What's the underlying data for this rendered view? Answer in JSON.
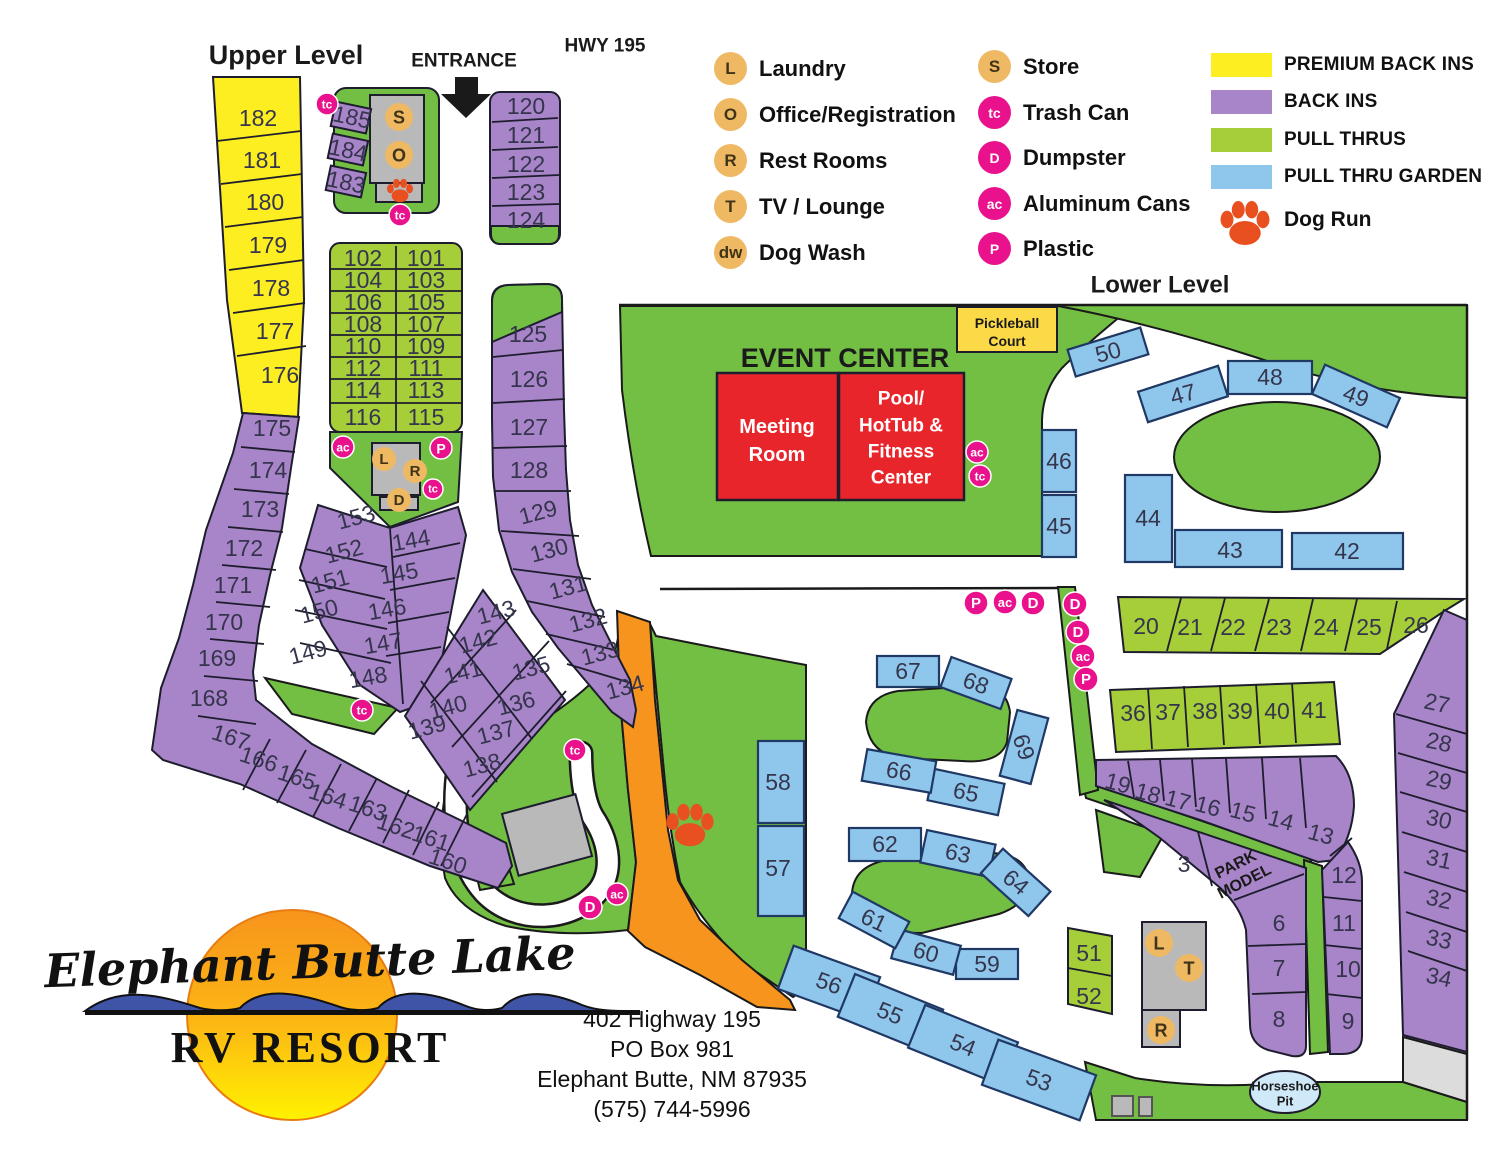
{
  "titles": {
    "upper_level": "Upper Level",
    "entrance": "ENTRANCE",
    "hwy": "HWY 195",
    "lower_level": "Lower Level",
    "event_center": "EVENT CENTER",
    "park_model": [
      "PARK",
      "MODEL"
    ],
    "horseshoe": [
      "Horseshoe",
      "Pit"
    ],
    "pickleball": [
      "Pickleball",
      "Court"
    ],
    "meeting_room": [
      "Meeting",
      "Room"
    ],
    "pool": [
      "Pool/",
      "HotTub &",
      "Fitness",
      "Center"
    ]
  },
  "legend": {
    "facilities": [
      {
        "abbr": "L",
        "label": "Laundry",
        "style": "tan"
      },
      {
        "abbr": "O",
        "label": "Office/Registration",
        "style": "tan"
      },
      {
        "abbr": "R",
        "label": "Rest Rooms",
        "style": "tan"
      },
      {
        "abbr": "T",
        "label": "TV / Lounge",
        "style": "tan"
      },
      {
        "abbr": "dw",
        "label": "Dog Wash",
        "style": "tan"
      },
      {
        "abbr": "S",
        "label": "Store",
        "style": "tan"
      },
      {
        "abbr": "tc",
        "label": "Trash Can",
        "style": "pink"
      },
      {
        "abbr": "D",
        "label": "Dumpster",
        "style": "pink"
      },
      {
        "abbr": "ac",
        "label": "Aluminum Cans",
        "style": "pink"
      },
      {
        "abbr": "P",
        "label": "Plastic",
        "style": "pink"
      }
    ],
    "site_types": [
      {
        "label": "PREMIUM BACK INS",
        "color": "#fcee21"
      },
      {
        "label": "BACK INS",
        "color": "#a884c8"
      },
      {
        "label": "PULL THRUS",
        "color": "#a6ce39"
      },
      {
        "label": "PULL THRU GARDEN",
        "color": "#8fc7ec"
      }
    ],
    "dog_run": "Dog Run"
  },
  "logo": {
    "script_line": "Elephant Butte Lake",
    "rv_line": "RV RESORT"
  },
  "address": {
    "lines": [
      "402 Highway 195",
      "PO Box 981",
      "Elephant Butte, NM 87935",
      "(575) 744-5996"
    ]
  },
  "colors": {
    "area_green": "#72bf44",
    "site_green": "#a6ce39",
    "back_in_purple": "#a884c8",
    "premium_yellow": "#fcee21",
    "garden_blue": "#8fc7ec",
    "road_orange": "#f7941d",
    "building_red": "#e8252a",
    "building_gray": "#b9b9b9",
    "marker_pink": "#e9118c",
    "marker_tan": "#efb964",
    "paw_orange": "#e8511f",
    "horseshoe_blue": "#cfe9f8"
  },
  "map": {
    "sites": [
      {
        "n": "182",
        "x": 258,
        "y": 118
      },
      {
        "n": "181",
        "x": 262,
        "y": 160
      },
      {
        "n": "180",
        "x": 265,
        "y": 202
      },
      {
        "n": "179",
        "x": 268,
        "y": 245
      },
      {
        "n": "178",
        "x": 271,
        "y": 288
      },
      {
        "n": "177",
        "x": 275,
        "y": 331
      },
      {
        "n": "176",
        "x": 280,
        "y": 375
      },
      {
        "n": "175",
        "x": 272,
        "y": 428
      },
      {
        "n": "174",
        "x": 268,
        "y": 470
      },
      {
        "n": "173",
        "x": 260,
        "y": 509
      },
      {
        "n": "172",
        "x": 244,
        "y": 548
      },
      {
        "n": "171",
        "x": 233,
        "y": 585
      },
      {
        "n": "170",
        "x": 224,
        "y": 622
      },
      {
        "n": "169",
        "x": 217,
        "y": 658
      },
      {
        "n": "168",
        "x": 209,
        "y": 698
      },
      {
        "n": "167",
        "x": 231,
        "y": 737,
        "r": 18
      },
      {
        "n": "166",
        "x": 259,
        "y": 759,
        "r": 18
      },
      {
        "n": "165",
        "x": 297,
        "y": 777,
        "r": 18
      },
      {
        "n": "164",
        "x": 328,
        "y": 796,
        "r": 18
      },
      {
        "n": "163",
        "x": 368,
        "y": 808,
        "r": 18
      },
      {
        "n": "162",
        "x": 396,
        "y": 826,
        "r": 18
      },
      {
        "n": "161",
        "x": 431,
        "y": 838,
        "r": 18
      },
      {
        "n": "160",
        "x": 448,
        "y": 861,
        "r": 18
      },
      {
        "n": "185",
        "x": 352,
        "y": 117,
        "fs": 20,
        "r": 12
      },
      {
        "n": "184",
        "x": 348,
        "y": 150,
        "fs": 20,
        "r": 12
      },
      {
        "n": "183",
        "x": 346,
        "y": 182,
        "fs": 20,
        "r": 12
      },
      {
        "n": "120",
        "x": 526,
        "y": 106,
        "fs": 22
      },
      {
        "n": "121",
        "x": 526,
        "y": 135,
        "fs": 22
      },
      {
        "n": "122",
        "x": 526,
        "y": 164,
        "fs": 22
      },
      {
        "n": "123",
        "x": 526,
        "y": 192,
        "fs": 22
      },
      {
        "n": "124",
        "x": 526,
        "y": 220,
        "fs": 22
      },
      {
        "n": "102",
        "x": 363,
        "y": 258,
        "fs": 22
      },
      {
        "n": "101",
        "x": 426,
        "y": 258,
        "fs": 22
      },
      {
        "n": "104",
        "x": 363,
        "y": 280,
        "fs": 22
      },
      {
        "n": "103",
        "x": 426,
        "y": 280,
        "fs": 22
      },
      {
        "n": "106",
        "x": 363,
        "y": 302,
        "fs": 22
      },
      {
        "n": "105",
        "x": 426,
        "y": 302,
        "fs": 22
      },
      {
        "n": "108",
        "x": 363,
        "y": 324,
        "fs": 22
      },
      {
        "n": "107",
        "x": 426,
        "y": 324,
        "fs": 22
      },
      {
        "n": "110",
        "x": 363,
        "y": 346,
        "fs": 22
      },
      {
        "n": "109",
        "x": 426,
        "y": 346,
        "fs": 22
      },
      {
        "n": "112",
        "x": 363,
        "y": 368,
        "fs": 22
      },
      {
        "n": "111",
        "x": 426,
        "y": 368,
        "fs": 22
      },
      {
        "n": "114",
        "x": 363,
        "y": 390,
        "fs": 22
      },
      {
        "n": "113",
        "x": 426,
        "y": 390,
        "fs": 22
      },
      {
        "n": "116",
        "x": 363,
        "y": 417,
        "fs": 22
      },
      {
        "n": "115",
        "x": 426,
        "y": 417,
        "fs": 22
      },
      {
        "n": "153",
        "x": 356,
        "y": 517,
        "r": -15
      },
      {
        "n": "152",
        "x": 344,
        "y": 551,
        "r": -15
      },
      {
        "n": "151",
        "x": 330,
        "y": 581,
        "r": -15
      },
      {
        "n": "150",
        "x": 319,
        "y": 611,
        "r": -15
      },
      {
        "n": "149",
        "x": 308,
        "y": 652,
        "r": -15
      },
      {
        "n": "144",
        "x": 411,
        "y": 540,
        "r": -10
      },
      {
        "n": "145",
        "x": 399,
        "y": 573,
        "r": -10
      },
      {
        "n": "146",
        "x": 387,
        "y": 609,
        "r": -10
      },
      {
        "n": "147",
        "x": 383,
        "y": 643,
        "r": -10
      },
      {
        "n": "148",
        "x": 368,
        "y": 677,
        "r": -10
      },
      {
        "n": "143",
        "x": 496,
        "y": 612,
        "r": -15
      },
      {
        "n": "142",
        "x": 478,
        "y": 641,
        "r": -15
      },
      {
        "n": "141",
        "x": 463,
        "y": 672,
        "r": -15
      },
      {
        "n": "140",
        "x": 448,
        "y": 707,
        "r": -15
      },
      {
        "n": "139",
        "x": 427,
        "y": 727,
        "r": -15
      },
      {
        "n": "135",
        "x": 531,
        "y": 668,
        "r": -15
      },
      {
        "n": "136",
        "x": 516,
        "y": 703,
        "r": -15
      },
      {
        "n": "137",
        "x": 496,
        "y": 732,
        "r": -15
      },
      {
        "n": "138",
        "x": 482,
        "y": 765,
        "r": -15
      },
      {
        "n": "125",
        "x": 528,
        "y": 334
      },
      {
        "n": "126",
        "x": 529,
        "y": 379
      },
      {
        "n": "127",
        "x": 529,
        "y": 427
      },
      {
        "n": "128",
        "x": 529,
        "y": 470
      },
      {
        "n": "129",
        "x": 538,
        "y": 512,
        "r": -15
      },
      {
        "n": "130",
        "x": 549,
        "y": 550,
        "r": -15
      },
      {
        "n": "131",
        "x": 568,
        "y": 587,
        "r": -15
      },
      {
        "n": "132",
        "x": 588,
        "y": 620,
        "r": -15
      },
      {
        "n": "133",
        "x": 600,
        "y": 653,
        "r": -15
      },
      {
        "n": "134",
        "x": 625,
        "y": 687,
        "r": -15
      },
      {
        "n": "58",
        "x": 778,
        "y": 782
      },
      {
        "n": "57",
        "x": 778,
        "y": 868
      },
      {
        "n": "56",
        "x": 829,
        "y": 983,
        "r": 20
      },
      {
        "n": "55",
        "x": 890,
        "y": 1013,
        "r": 22
      },
      {
        "n": "54",
        "x": 963,
        "y": 1045,
        "r": 22
      },
      {
        "n": "53",
        "x": 1039,
        "y": 1080,
        "r": 20
      },
      {
        "n": "59",
        "x": 987,
        "y": 964
      },
      {
        "n": "60",
        "x": 926,
        "y": 952,
        "r": 15
      },
      {
        "n": "61",
        "x": 874,
        "y": 920,
        "r": 25
      },
      {
        "n": "62",
        "x": 885,
        "y": 844
      },
      {
        "n": "63",
        "x": 958,
        "y": 853,
        "r": 12
      },
      {
        "n": "64",
        "x": 1016,
        "y": 882,
        "r": 40
      },
      {
        "n": "65",
        "x": 966,
        "y": 792,
        "r": 12
      },
      {
        "n": "66",
        "x": 899,
        "y": 771,
        "r": 10
      },
      {
        "n": "67",
        "x": 908,
        "y": 671
      },
      {
        "n": "68",
        "x": 976,
        "y": 683,
        "r": 20
      },
      {
        "n": "69",
        "x": 1024,
        "y": 747,
        "r": 72
      },
      {
        "n": "50",
        "x": 1108,
        "y": 352,
        "r": -15
      },
      {
        "n": "47",
        "x": 1183,
        "y": 394,
        "r": -15
      },
      {
        "n": "48",
        "x": 1270,
        "y": 377
      },
      {
        "n": "49",
        "x": 1356,
        "y": 396,
        "r": 20
      },
      {
        "n": "46",
        "x": 1059,
        "y": 461
      },
      {
        "n": "45",
        "x": 1059,
        "y": 526
      },
      {
        "n": "44",
        "x": 1148,
        "y": 518
      },
      {
        "n": "43",
        "x": 1230,
        "y": 550
      },
      {
        "n": "42",
        "x": 1347,
        "y": 551
      },
      {
        "n": "51",
        "x": 1089,
        "y": 953
      },
      {
        "n": "52",
        "x": 1089,
        "y": 996
      },
      {
        "n": "20",
        "x": 1146,
        "y": 626
      },
      {
        "n": "21",
        "x": 1190,
        "y": 627
      },
      {
        "n": "22",
        "x": 1233,
        "y": 627
      },
      {
        "n": "23",
        "x": 1279,
        "y": 627
      },
      {
        "n": "24",
        "x": 1326,
        "y": 627
      },
      {
        "n": "25",
        "x": 1369,
        "y": 627
      },
      {
        "n": "26",
        "x": 1416,
        "y": 625
      },
      {
        "n": "36",
        "x": 1133,
        "y": 713
      },
      {
        "n": "37",
        "x": 1168,
        "y": 712
      },
      {
        "n": "38",
        "x": 1205,
        "y": 711
      },
      {
        "n": "39",
        "x": 1240,
        "y": 711
      },
      {
        "n": "40",
        "x": 1277,
        "y": 711
      },
      {
        "n": "41",
        "x": 1314,
        "y": 710
      },
      {
        "n": "19",
        "x": 1118,
        "y": 783,
        "r": 15
      },
      {
        "n": "18",
        "x": 1148,
        "y": 793,
        "r": 15
      },
      {
        "n": "17",
        "x": 1178,
        "y": 800,
        "r": 15
      },
      {
        "n": "16",
        "x": 1208,
        "y": 806,
        "r": 15
      },
      {
        "n": "15",
        "x": 1243,
        "y": 812,
        "r": 15
      },
      {
        "n": "14",
        "x": 1281,
        "y": 820,
        "r": 15
      },
      {
        "n": "13",
        "x": 1321,
        "y": 834,
        "r": 15
      },
      {
        "n": "3",
        "x": 1184,
        "y": 864
      },
      {
        "n": "12",
        "x": 1344,
        "y": 875
      },
      {
        "n": "11",
        "x": 1344,
        "y": 923
      },
      {
        "n": "6",
        "x": 1279,
        "y": 923
      },
      {
        "n": "7",
        "x": 1279,
        "y": 968
      },
      {
        "n": "10",
        "x": 1348,
        "y": 969
      },
      {
        "n": "8",
        "x": 1279,
        "y": 1019
      },
      {
        "n": "9",
        "x": 1348,
        "y": 1021
      },
      {
        "n": "27",
        "x": 1437,
        "y": 703,
        "r": 12
      },
      {
        "n": "28",
        "x": 1439,
        "y": 742,
        "r": 12
      },
      {
        "n": "29",
        "x": 1439,
        "y": 780,
        "r": 12
      },
      {
        "n": "30",
        "x": 1439,
        "y": 819,
        "r": 12
      },
      {
        "n": "31",
        "x": 1439,
        "y": 859,
        "r": 12
      },
      {
        "n": "32",
        "x": 1439,
        "y": 899,
        "r": 12
      },
      {
        "n": "33",
        "x": 1439,
        "y": 939,
        "r": 12
      },
      {
        "n": "34",
        "x": 1439,
        "y": 977,
        "r": 12
      }
    ],
    "markers": [
      {
        "k": "tan",
        "t": "S",
        "x": 399,
        "y": 117,
        "cr": 14
      },
      {
        "k": "tan",
        "t": "O",
        "x": 399,
        "y": 155,
        "cr": 14
      },
      {
        "k": "tan",
        "t": "L",
        "x": 384,
        "y": 459,
        "cr": 12
      },
      {
        "k": "tan",
        "t": "R",
        "x": 415,
        "y": 471,
        "cr": 12
      },
      {
        "k": "tan",
        "t": "D",
        "x": 399,
        "y": 500,
        "cr": 12
      },
      {
        "k": "tan",
        "t": "L",
        "x": 1159,
        "y": 943,
        "cr": 14
      },
      {
        "k": "tan",
        "t": "T",
        "x": 1189,
        "y": 968,
        "cr": 14
      },
      {
        "k": "tan",
        "t": "R",
        "x": 1161,
        "y": 1030,
        "cr": 14
      },
      {
        "k": "pink",
        "t": "tc",
        "x": 327,
        "y": 104,
        "cr": 11
      },
      {
        "k": "pink",
        "t": "tc",
        "x": 400,
        "y": 215,
        "cr": 11
      },
      {
        "k": "pink",
        "t": "ac",
        "x": 343,
        "y": 447,
        "cr": 11
      },
      {
        "k": "pink",
        "t": "P",
        "x": 441,
        "y": 448,
        "cr": 11
      },
      {
        "k": "pink",
        "t": "tc",
        "x": 433,
        "y": 489,
        "cr": 10
      },
      {
        "k": "pink",
        "t": "tc",
        "x": 362,
        "y": 710,
        "cr": 11
      },
      {
        "k": "pink",
        "t": "tc",
        "x": 575,
        "y": 750,
        "cr": 11
      },
      {
        "k": "pink",
        "t": "D",
        "x": 590,
        "y": 907,
        "cr": 12
      },
      {
        "k": "pink",
        "t": "ac",
        "x": 617,
        "y": 894,
        "cr": 11
      },
      {
        "k": "pink",
        "t": "P",
        "x": 976,
        "y": 603,
        "cr": 12
      },
      {
        "k": "pink",
        "t": "ac",
        "x": 1005,
        "y": 602,
        "cr": 12
      },
      {
        "k": "pink",
        "t": "D",
        "x": 1033,
        "y": 603,
        "cr": 12
      },
      {
        "k": "pink",
        "t": "D",
        "x": 1075,
        "y": 604,
        "cr": 12
      },
      {
        "k": "pink",
        "t": "D",
        "x": 1078,
        "y": 632,
        "cr": 12
      },
      {
        "k": "pink",
        "t": "ac",
        "x": 1083,
        "y": 656,
        "cr": 12
      },
      {
        "k": "pink",
        "t": "P",
        "x": 1086,
        "y": 679,
        "cr": 12
      },
      {
        "k": "pink",
        "t": "ac",
        "x": 977,
        "y": 452,
        "cr": 11
      },
      {
        "k": "pink",
        "t": "tc",
        "x": 980,
        "y": 476,
        "cr": 11
      }
    ],
    "paws": [
      {
        "x": 1245,
        "y": 224,
        "s": 1.5
      },
      {
        "x": 400,
        "y": 191,
        "s": 0.8
      },
      {
        "x": 690,
        "y": 826,
        "s": 1.45
      }
    ]
  }
}
